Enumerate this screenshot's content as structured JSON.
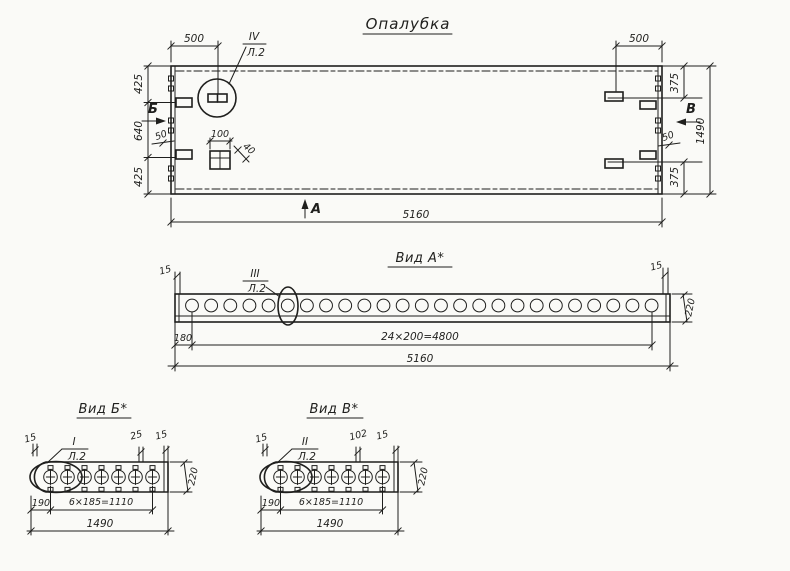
{
  "title": "Опалубка",
  "colors": {
    "ink": "#1f1f1d",
    "paper": "#fafaf7"
  },
  "plan": {
    "dim_500_left": "500",
    "dim_500_right": "500",
    "dim_425_top": "425",
    "dim_640_mid": "640",
    "dim_425_bottom": "425",
    "dim_375_top": "375",
    "dim_375_bottom": "375",
    "dim_1490_right": "1490",
    "dim_50_left": "50",
    "dim_50_right": "50",
    "dim_100": "100",
    "dim_40": "40",
    "dim_5160_bottom": "5160",
    "marker_a": "А",
    "marker_b": "Б",
    "marker_v": "В",
    "callout": {
      "num": "IV",
      "sheet": "Л.2"
    }
  },
  "view_a": {
    "title": "Вид А*",
    "callout": {
      "num": "III",
      "sheet": "Л.2"
    },
    "dim_15_left": "15",
    "dim_15_right": "15",
    "dim_220": "220",
    "dim_180": "180",
    "dim_spacing": "24×200=4800",
    "dim_5160": "5160",
    "hole_count": 25
  },
  "view_b": {
    "title": "Вид Б*",
    "callout": {
      "num": "I",
      "sheet": "Л.2"
    },
    "dim_15_left": "15",
    "dim_25": "25",
    "dim_15_right": "15",
    "dim_220": "220",
    "dim_190": "190",
    "dim_spacing": "6×185=1110",
    "dim_1490": "1490",
    "hole_count": 7
  },
  "view_v": {
    "title": "Вид В*",
    "callout": {
      "num": "II",
      "sheet": "Л.2"
    },
    "dim_15_left": "15",
    "dim_102": "102",
    "dim_15_right": "15",
    "dim_220": "220",
    "dim_190": "190",
    "dim_spacing": "6×185=1110",
    "dim_1490": "1490",
    "hole_count": 7
  }
}
